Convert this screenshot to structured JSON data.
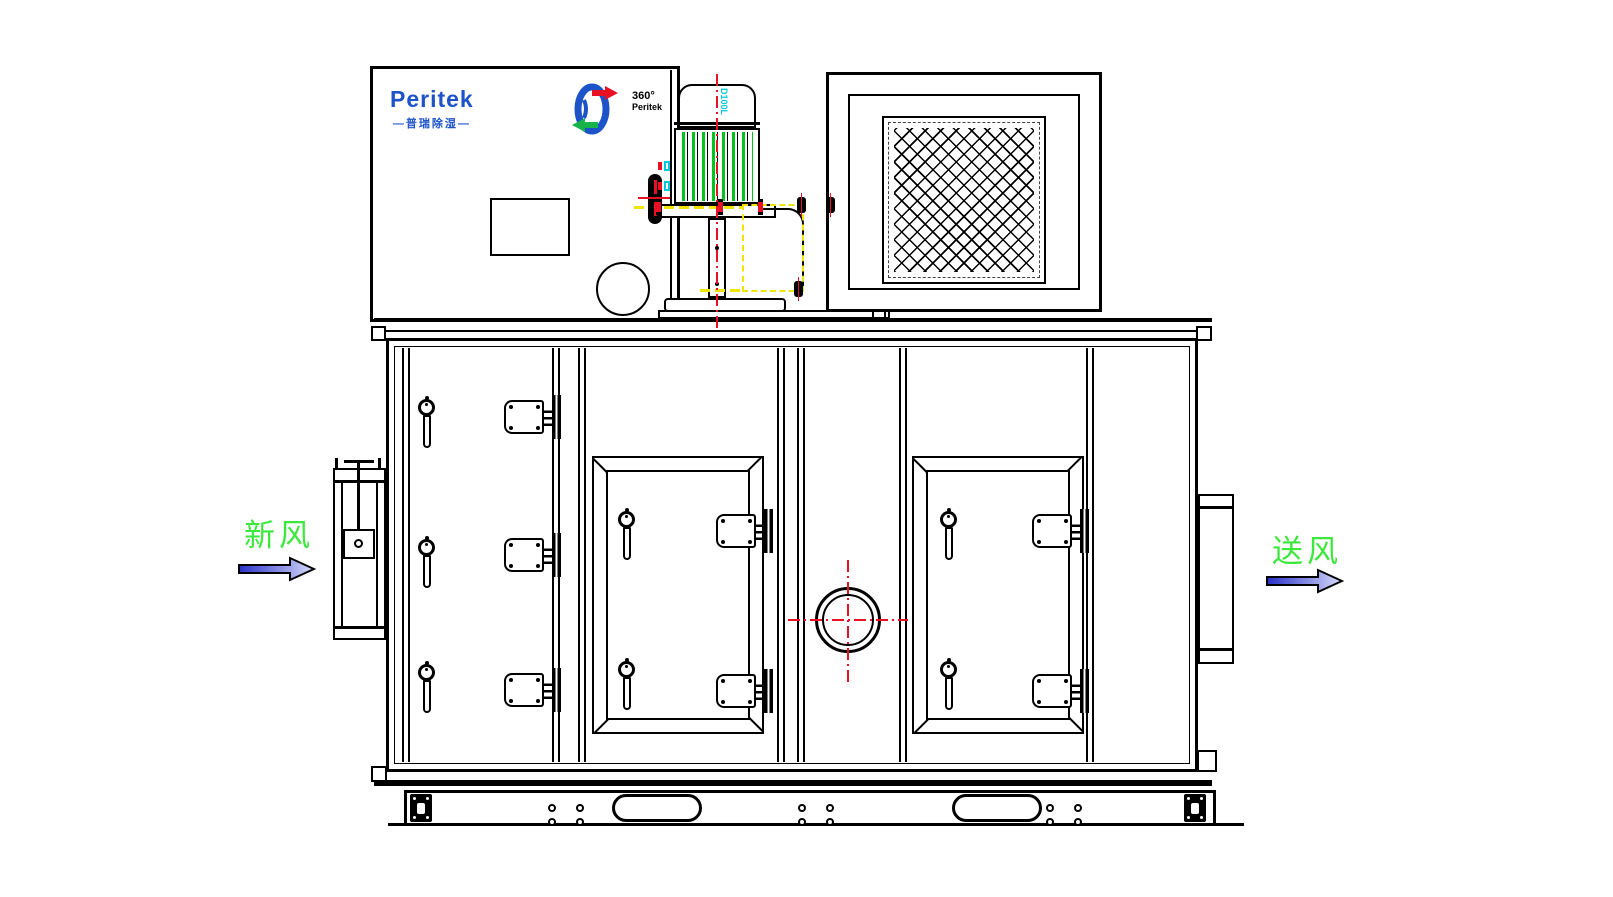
{
  "texts": {
    "brand": "Peritek",
    "brand_cn": "—普瑞除湿—",
    "badge_degree": "360°",
    "badge_name": "Peritek",
    "motor_frame": "D100L",
    "inlet_label": "新风",
    "outlet_label": "送风"
  },
  "colors": {
    "line": "#000000",
    "brand-blue": "#1d53c8",
    "fin-green": "#00c41e",
    "label-green": "#3ce83c",
    "center-red": "#e81123",
    "hidden-yellow": "#f0e400",
    "accent-cyan": "#00c8dc",
    "arrow-dark": "#2830c8",
    "arrow-light": "#d8dcfa",
    "arrow-green": "#17b24a"
  }
}
